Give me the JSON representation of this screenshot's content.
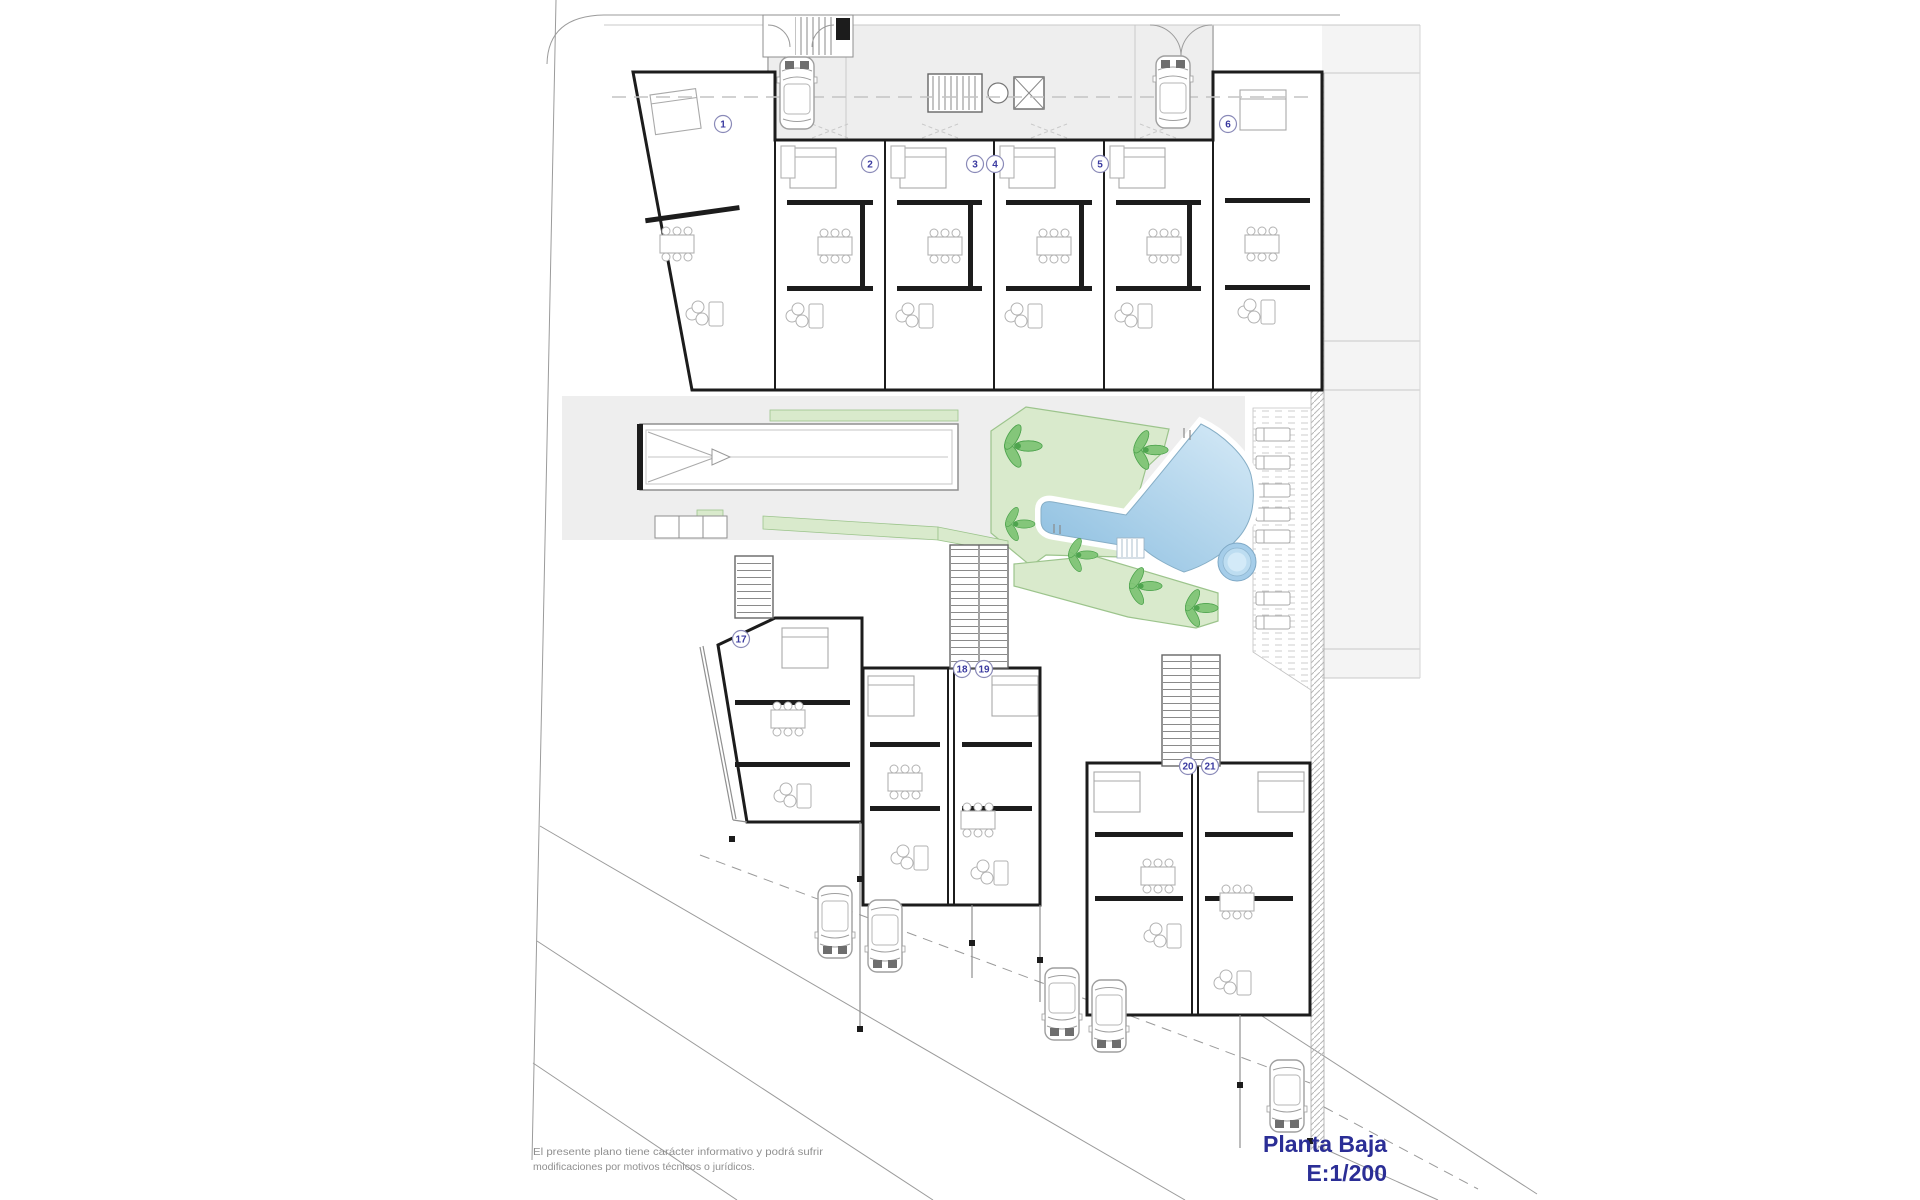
{
  "plan": {
    "title": "Planta Baja",
    "scale": "E:1/200",
    "disclaimer_line1": "El presente plano tiene carácter informativo y podrá sufrir",
    "disclaimer_line2": "modificaciones por motivos técnicos o jurídicos.",
    "units": {
      "top": [
        "1",
        "2",
        "3",
        "4",
        "5",
        "6"
      ],
      "bottom": [
        "17",
        "18",
        "19",
        "20",
        "21"
      ]
    },
    "symbols": [
      "car",
      "palm-tree",
      "sun-lounger",
      "dining-table",
      "sofa",
      "stairs",
      "pool-ladder",
      "elevator",
      "spa"
    ],
    "colors": {
      "title_text": "#2b2e96",
      "disclaimer_text": "#8f8f8f",
      "lawn": "#d9eacc",
      "lawn_border": "#9cc48c",
      "palm": "#82c578",
      "palm_dark": "#4ea44e",
      "pool_light": "#d6eaf7",
      "pool_dark": "#8abddf",
      "pool_edge": "#86aec6",
      "spa": "#a5cde9",
      "courtyard": "#eeeeee",
      "right_band": "#f4f4f4",
      "walls": "#1c1c1c",
      "furniture": "#b2b2b2",
      "boundary": "#9b9b9b"
    }
  }
}
